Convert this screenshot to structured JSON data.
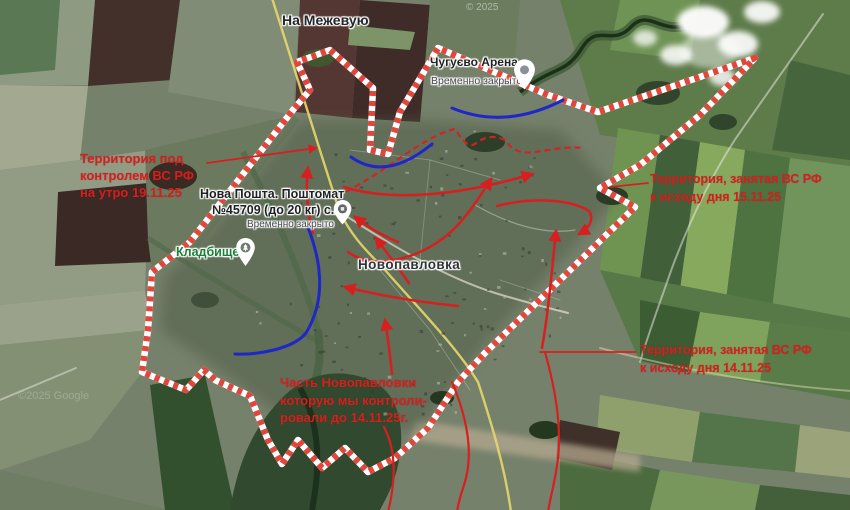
{
  "map": {
    "region_labels": {
      "road_direction": "На Межевую",
      "city": "Новопавловка"
    },
    "watermarks": {
      "top": "© 2025",
      "bottom": "©2025 Google"
    },
    "pois": [
      {
        "name": "Чугуєво Арена",
        "status": "Временно закрыто",
        "icon": "arena-place-pin"
      },
      {
        "name_line1": "Нова Пошта. Поштомат",
        "name_line2": "№45709 (до 20 кг) с...",
        "status": "Временно закрыто",
        "icon": "parcel-locker-pin"
      },
      {
        "name": "Кладбище",
        "icon": "cemetery-pin"
      }
    ],
    "annotations": [
      {
        "id": "controlled-area-note",
        "lines": [
          "Территория под",
          "контролем ВС РФ",
          "на утро 19.11.25"
        ]
      },
      {
        "id": "captured-15-11-note",
        "lines": [
          "Территория, занятая ВС РФ",
          "к исходу дня 15.11.25"
        ]
      },
      {
        "id": "captured-14-11-note",
        "lines": [
          "Территория, занятая ВС РФ",
          "к исходу дня 14.11.25"
        ]
      },
      {
        "id": "town-part-note",
        "lines": [
          "Часть Новопавловки",
          "которую мы контроли-",
          "ровали до 14.11.25г."
        ]
      }
    ],
    "legend_colors": {
      "front_line_red": "#e2453c",
      "annotation_red": "#d51f1f",
      "defense_blue": "#1f27c8",
      "road_yellow": "#e7d76d"
    }
  }
}
